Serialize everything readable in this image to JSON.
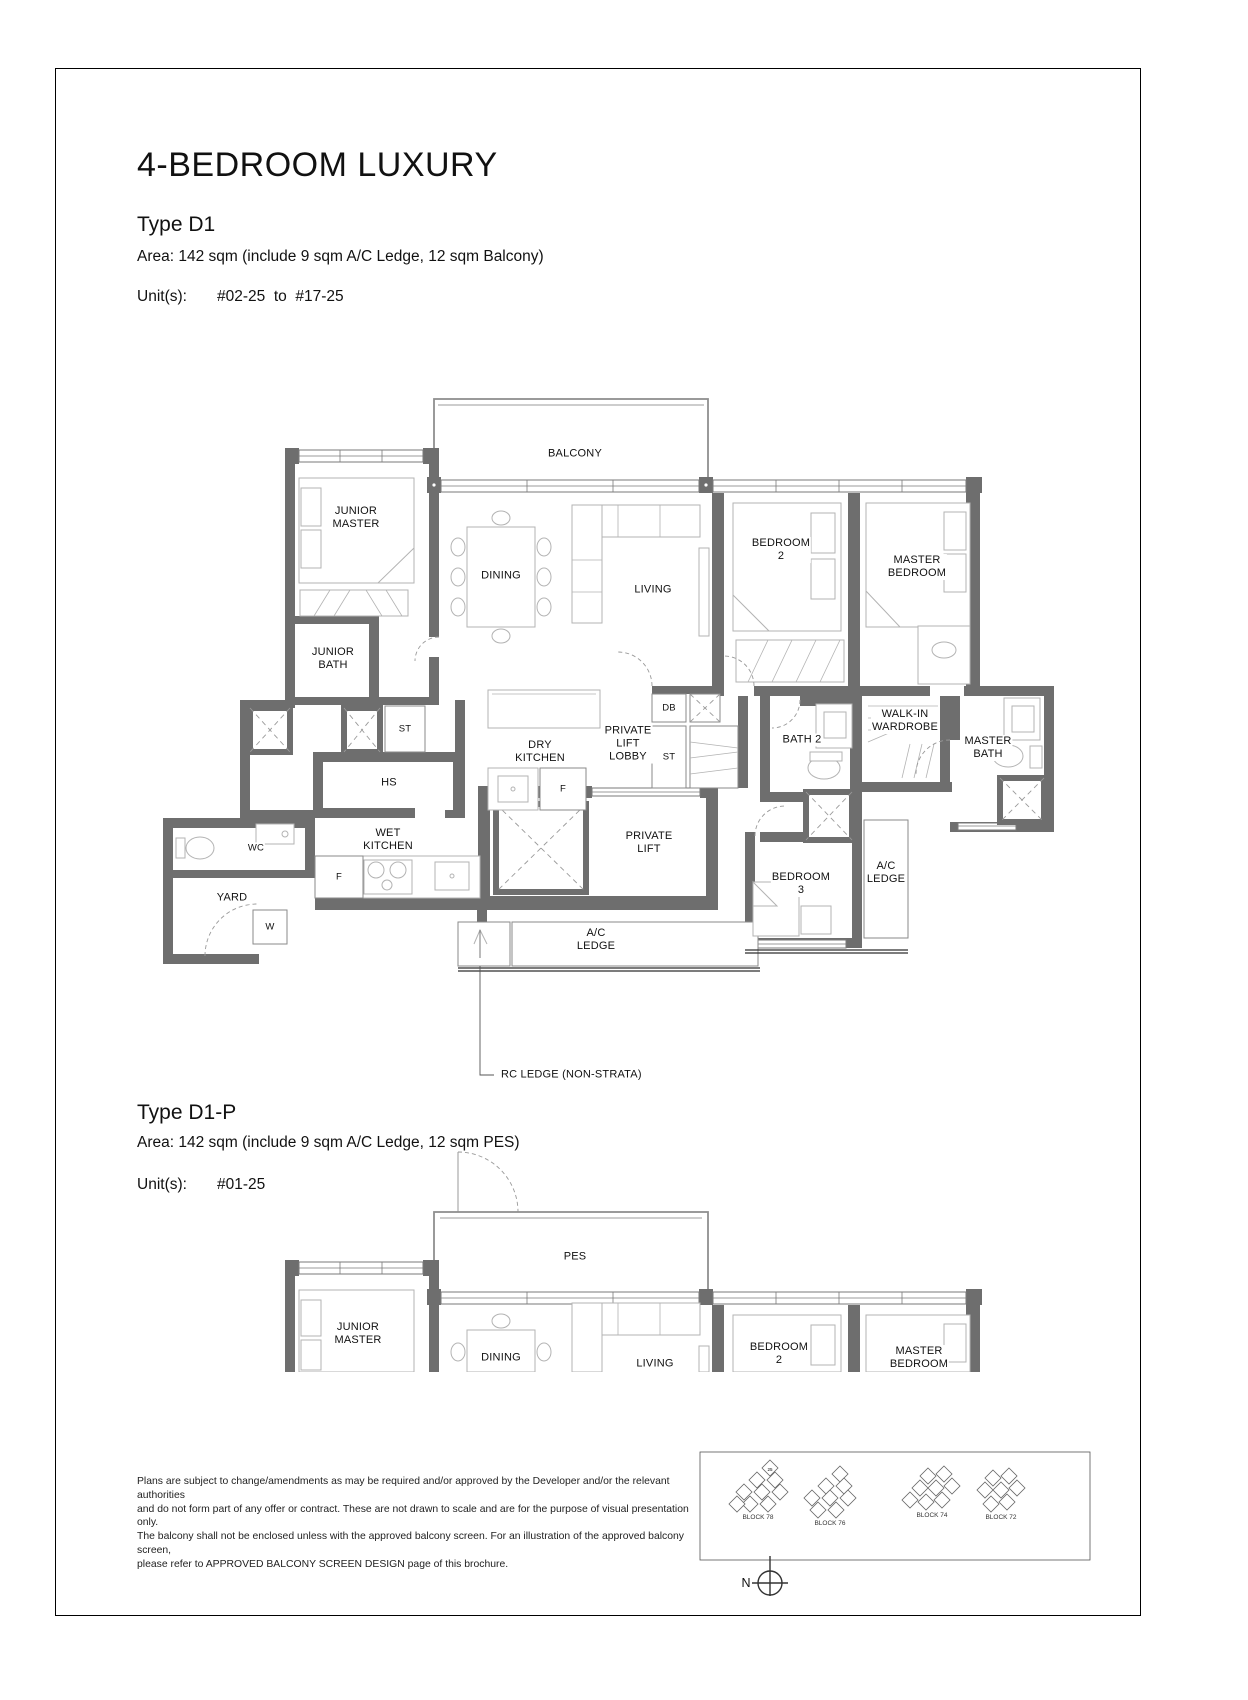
{
  "colors": {
    "wall": "#6e6e6e",
    "highlighted_unit": "#9a9a9a"
  },
  "header": {
    "title": "4-BEDROOM LUXURY"
  },
  "type_d1": {
    "name": "Type D1",
    "area": "Area: 142 sqm (include 9 sqm A/C Ledge, 12 sqm Balcony)",
    "units_label": "Unit(s):",
    "units_value": "#02-25  to  #17-25"
  },
  "plan_d1": {
    "labels": {
      "balcony": "BALCONY",
      "junior_master": "JUNIOR\nMASTER",
      "dining": "DINING",
      "living": "LIVING",
      "bedroom_2": "BEDROOM\n2",
      "master_bedroom": "MASTER\nBEDROOM",
      "junior_bath": "JUNIOR\nBATH",
      "st_upper": "ST",
      "dry_kitchen": "DRY\nKITCHEN",
      "private_lift_lobby": "PRIVATE\nLIFT\nLOBBY",
      "db": "DB",
      "st_lobby": "ST",
      "bath_2": "BATH 2",
      "walk_in_wardrobe": "WALK-IN\nWARDROBE",
      "master_bath": "MASTER\nBATH",
      "hs": "HS",
      "wet_kitchen": "WET\nKITCHEN",
      "wc": "WC",
      "yard": "YARD",
      "washer": "W",
      "fridge_wet": "F",
      "fridge_dry": "F",
      "private_lift": "PRIVATE\nLIFT",
      "bedroom_3": "BEDROOM\n3",
      "ac_ledge_right": "A/C\nLEDGE",
      "ac_ledge_bottom": "A/C\nLEDGE",
      "rc_ledge_note": "RC LEDGE (NON-STRATA)"
    }
  },
  "type_d1p": {
    "name": "Type D1-P",
    "area": "Area: 142 sqm (include 9 sqm A/C Ledge, 12 sqm PES)",
    "units_label": "Unit(s):",
    "units_value": "#01-25"
  },
  "plan_d1p": {
    "labels": {
      "pes": "PES",
      "junior_master": "JUNIOR\nMASTER",
      "dining": "DINING",
      "living": "LIVING",
      "bedroom_2": "BEDROOM\n2",
      "master_bedroom": "MASTER\nBEDROOM"
    }
  },
  "footer": {
    "disclaimer": "Plans are subject to change/amendments as may be required and/or approved by the Developer and/or the relevant authorities\nand do not form part of any offer or contract. These are not drawn to scale and are for the purpose of visual presentation only.\nThe balcony shall not be enclosed unless with the approved balcony screen. For an illustration of the approved balcony screen,\nplease refer to APPROVED BALCONY SCREEN DESIGN page of this brochure."
  },
  "key_plan": {
    "blocks": [
      {
        "label": "BLOCK 78"
      },
      {
        "label": "BLOCK 76"
      },
      {
        "label": "BLOCK 74"
      },
      {
        "label": "BLOCK 72"
      }
    ],
    "highlighted_unit": "25"
  },
  "compass": {
    "north_label": "N"
  }
}
